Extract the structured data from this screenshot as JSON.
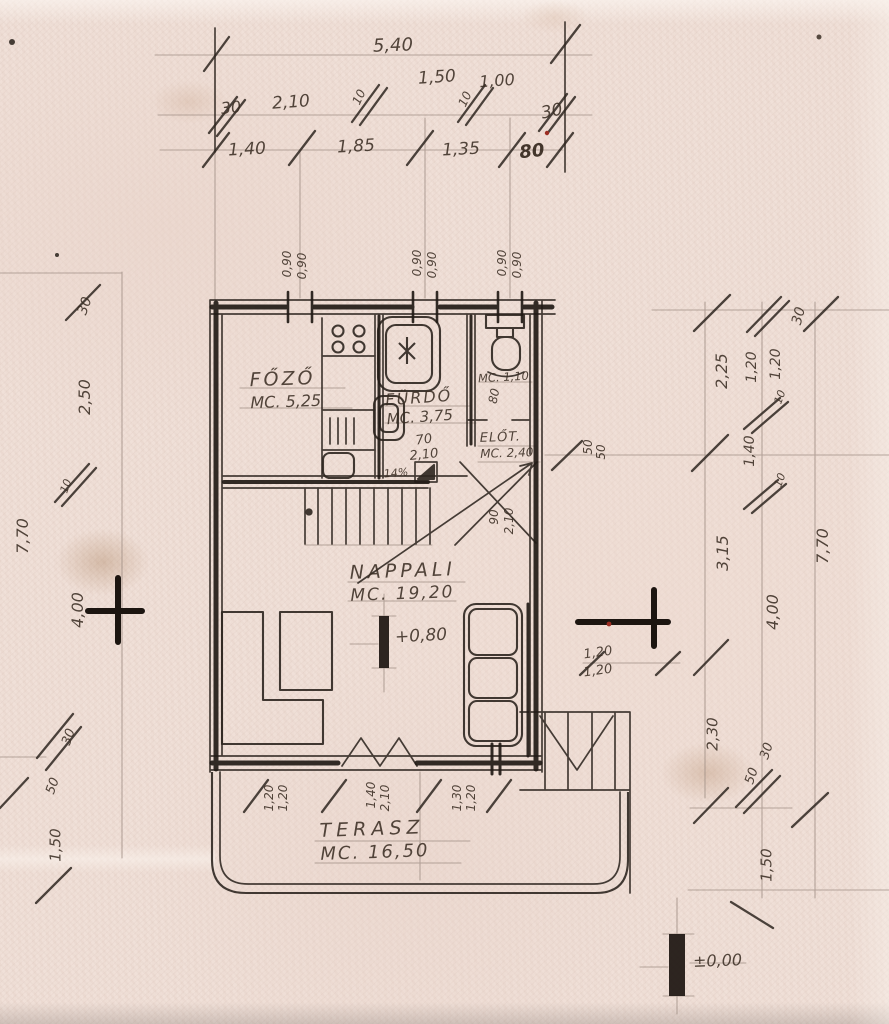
{
  "document": {
    "kind": "scanned hand-drawn architectural floor plan",
    "language": "Hungarian"
  },
  "colors": {
    "paper": "#f0e0d8",
    "ink": "#2e2620",
    "pencil": "#a08f85",
    "stain": "#c9a98f",
    "red_speck": "#9c2d22"
  },
  "rooms": {
    "fozo": {
      "name": "FŐZŐ",
      "area": "MC. 5,25"
    },
    "furdo": {
      "name": "FÜRDŐ",
      "area": "MC. 3,75"
    },
    "wc": {
      "area": "MC. 1,10"
    },
    "elot": {
      "name": "ELŐT.",
      "area": "MC. 2,40"
    },
    "nappali": {
      "name": "NAPPALI",
      "area": "MC. 19,20"
    },
    "terasz": {
      "name": "TERASZ",
      "area": "MC. 16,50"
    }
  },
  "levels": {
    "floor": "+0,80",
    "ground": "±0,00"
  },
  "dimension_chains": {
    "top_total": "5,40",
    "top_row2": [
      "30",
      "2,10",
      "10",
      "1,50",
      "10",
      "1,00",
      "30"
    ],
    "top_row3": [
      "1,40",
      "1,85",
      "1,35",
      "80"
    ],
    "left": [
      "30",
      "2,50",
      "10",
      "7,70",
      "4,00",
      "30",
      "50",
      "1,50"
    ],
    "right_inner": [
      "2,25",
      "3,15",
      "2,30"
    ],
    "right_mid": [
      "1,20",
      "1,20",
      "10",
      "1,40",
      "10",
      "4,00",
      "30",
      "50",
      "1,50"
    ],
    "right_outer": [
      "30",
      "7,70"
    ],
    "window_marks_top": [
      "0,90 / 0,90",
      "0,90 / 0,90",
      "0,90 / 0,90"
    ],
    "bottom_openings": [
      [
        "1,20",
        "1,20"
      ],
      [
        "1,40",
        "2,10"
      ],
      [
        "1,30",
        "1,20"
      ]
    ],
    "misc": [
      "80",
      "70",
      "2,10",
      "14%",
      "90",
      "2,10",
      "50",
      "50",
      "1,20",
      "1,20"
    ]
  },
  "annotations": [
    {
      "t": "5,40",
      "x": 393,
      "y": 46,
      "r": -2,
      "s": 18
    },
    {
      "t": "1,50",
      "x": 437,
      "y": 78,
      "r": -4,
      "s": 17
    },
    {
      "t": "1,00",
      "x": 497,
      "y": 81,
      "r": -4,
      "s": 16
    },
    {
      "t": "30",
      "x": 231,
      "y": 108,
      "r": -6,
      "s": 16
    },
    {
      "t": "2,10",
      "x": 291,
      "y": 103,
      "r": -4,
      "s": 17
    },
    {
      "t": "10",
      "x": 359,
      "y": 97,
      "r": -65,
      "s": 12
    },
    {
      "t": "10",
      "x": 465,
      "y": 99,
      "r": -65,
      "s": 12
    },
    {
      "t": "30",
      "x": 552,
      "y": 112,
      "r": -12,
      "s": 17
    },
    {
      "t": "1,40",
      "x": 247,
      "y": 150,
      "r": -3,
      "s": 17
    },
    {
      "t": "1,85",
      "x": 356,
      "y": 147,
      "r": -3,
      "s": 17
    },
    {
      "t": "1,35",
      "x": 461,
      "y": 150,
      "r": -3,
      "s": 17
    },
    {
      "t": "80",
      "x": 532,
      "y": 152,
      "r": -6,
      "s": 18,
      "b": 1
    },
    {
      "t": "0,90",
      "x": 287,
      "y": 264,
      "r": -90,
      "s": 12
    },
    {
      "t": "0,90",
      "x": 302,
      "y": 266,
      "r": -90,
      "s": 12
    },
    {
      "t": "0,90",
      "x": 417,
      "y": 263,
      "r": -90,
      "s": 12
    },
    {
      "t": "0,90",
      "x": 432,
      "y": 265,
      "r": -90,
      "s": 12
    },
    {
      "t": "0,90",
      "x": 502,
      "y": 263,
      "r": -90,
      "s": 12
    },
    {
      "t": "0,90",
      "x": 517,
      "y": 265,
      "r": -90,
      "s": 12
    },
    {
      "t": "80",
      "x": 494,
      "y": 396,
      "r": -78,
      "s": 12
    },
    {
      "t": "70",
      "x": 424,
      "y": 440,
      "r": -8,
      "s": 13
    },
    {
      "t": "2,10",
      "x": 424,
      "y": 455,
      "r": -6,
      "s": 13
    },
    {
      "t": "14%",
      "x": 396,
      "y": 473,
      "r": -5,
      "s": 11
    },
    {
      "t": "90",
      "x": 494,
      "y": 517,
      "r": -90,
      "s": 12
    },
    {
      "t": "2,10",
      "x": 509,
      "y": 521,
      "r": -90,
      "s": 12
    },
    {
      "t": "50",
      "x": 588,
      "y": 447,
      "r": -90,
      "s": 12
    },
    {
      "t": "50",
      "x": 601,
      "y": 452,
      "r": -90,
      "s": 12
    },
    {
      "t": "30",
      "x": 799,
      "y": 316,
      "r": -75,
      "s": 14
    },
    {
      "t": "2,25",
      "x": 722,
      "y": 371,
      "r": -90,
      "s": 16
    },
    {
      "t": "1,20",
      "x": 752,
      "y": 367,
      "r": -90,
      "s": 14
    },
    {
      "t": "1,20",
      "x": 776,
      "y": 364,
      "r": -90,
      "s": 14
    },
    {
      "t": "10",
      "x": 780,
      "y": 397,
      "r": -70,
      "s": 11
    },
    {
      "t": "1,40",
      "x": 750,
      "y": 451,
      "r": -90,
      "s": 14
    },
    {
      "t": "10",
      "x": 780,
      "y": 480,
      "r": -70,
      "s": 11
    },
    {
      "t": "3,15",
      "x": 723,
      "y": 553,
      "r": -90,
      "s": 16
    },
    {
      "t": "7,70",
      "x": 823,
      "y": 546,
      "r": -90,
      "s": 16
    },
    {
      "t": "4,00",
      "x": 773,
      "y": 612,
      "r": -90,
      "s": 16
    },
    {
      "t": "2,30",
      "x": 713,
      "y": 734,
      "r": -90,
      "s": 15
    },
    {
      "t": "30",
      "x": 767,
      "y": 751,
      "r": -72,
      "s": 13
    },
    {
      "t": "50",
      "x": 752,
      "y": 776,
      "r": -72,
      "s": 13
    },
    {
      "t": "1,50",
      "x": 767,
      "y": 865,
      "r": -90,
      "s": 15
    },
    {
      "t": "1,20",
      "x": 598,
      "y": 653,
      "r": -8,
      "s": 13
    },
    {
      "t": "1,20",
      "x": 598,
      "y": 671,
      "r": -8,
      "s": 13
    },
    {
      "t": "30",
      "x": 85,
      "y": 306,
      "r": -70,
      "s": 14
    },
    {
      "t": "2,50",
      "x": 85,
      "y": 397,
      "r": -90,
      "s": 16
    },
    {
      "t": "10",
      "x": 66,
      "y": 486,
      "r": -70,
      "s": 11
    },
    {
      "t": "7,70",
      "x": 23,
      "y": 536,
      "r": -90,
      "s": 16
    },
    {
      "t": "4,00",
      "x": 78,
      "y": 610,
      "r": -90,
      "s": 16
    },
    {
      "t": "30",
      "x": 69,
      "y": 737,
      "r": -70,
      "s": 13
    },
    {
      "t": "50",
      "x": 53,
      "y": 786,
      "r": -70,
      "s": 13
    },
    {
      "t": "1,50",
      "x": 56,
      "y": 845,
      "r": -90,
      "s": 15
    },
    {
      "t": "1,20",
      "x": 269,
      "y": 798,
      "r": -90,
      "s": 12
    },
    {
      "t": "1,20",
      "x": 283,
      "y": 798,
      "r": -90,
      "s": 12
    },
    {
      "t": "1,40",
      "x": 371,
      "y": 795,
      "r": -90,
      "s": 12
    },
    {
      "t": "2,10",
      "x": 385,
      "y": 798,
      "r": -90,
      "s": 12
    },
    {
      "t": "1,30",
      "x": 457,
      "y": 798,
      "r": -90,
      "s": 12
    },
    {
      "t": "1,20",
      "x": 471,
      "y": 798,
      "r": -90,
      "s": 12
    }
  ]
}
